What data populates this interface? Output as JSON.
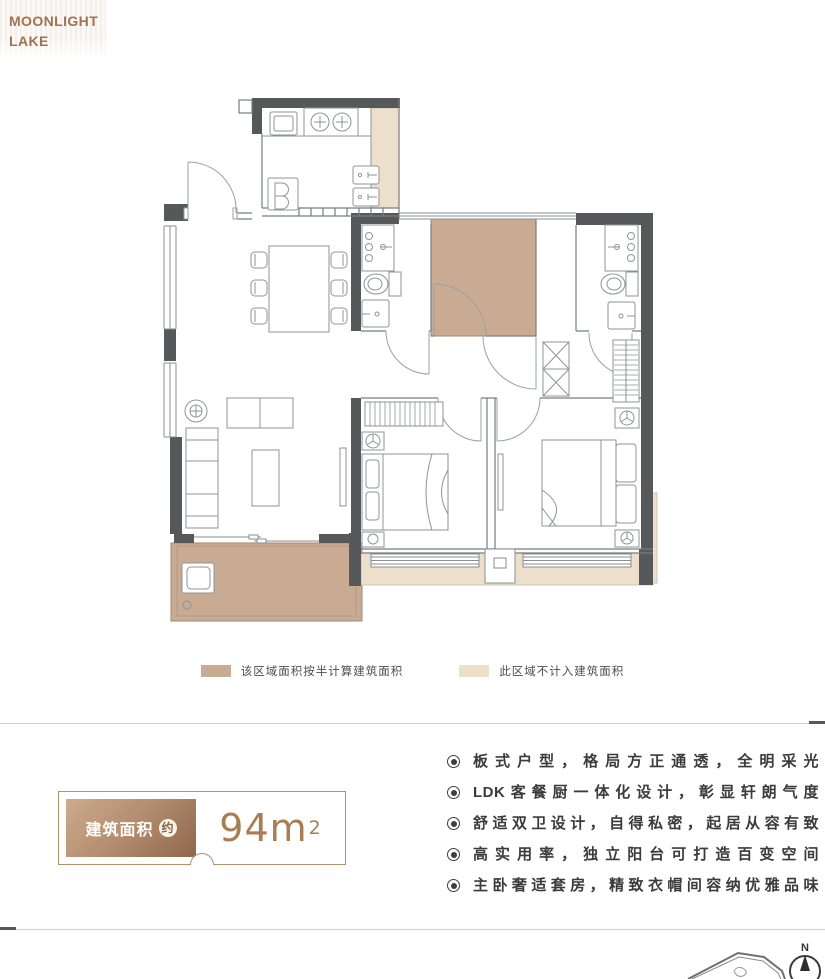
{
  "logo": {
    "line1": "MOONLIGHT",
    "line2": "LAKE"
  },
  "floor_plan": {
    "colors": {
      "wall": "#57585a",
      "half_area_fill": "#c9ab93",
      "excluded_area_fill": "#ece0cd",
      "line": "#797d81"
    }
  },
  "legend": {
    "items": [
      {
        "swatch_color": "#c9ab93",
        "label": "该区域面积按半计算建筑面积"
      },
      {
        "swatch_color": "#ece0cd",
        "label": "此区域不计入建筑面积"
      }
    ]
  },
  "area_badge": {
    "label": "建筑面积",
    "approx_mark": "约",
    "value": "94m",
    "superscript": "2"
  },
  "features": {
    "items": [
      "板式户型，格局方正通透，全明采光",
      "LDK客餐厨一体化设计，彰显轩朗气度",
      "舒适双卫设计，自得私密，起居从容有致",
      "高实用率，独立阳台可打造百变空间",
      "主卧奢适套房，精致衣帽间容纳优雅品味"
    ]
  },
  "compass": {
    "label": "N"
  }
}
